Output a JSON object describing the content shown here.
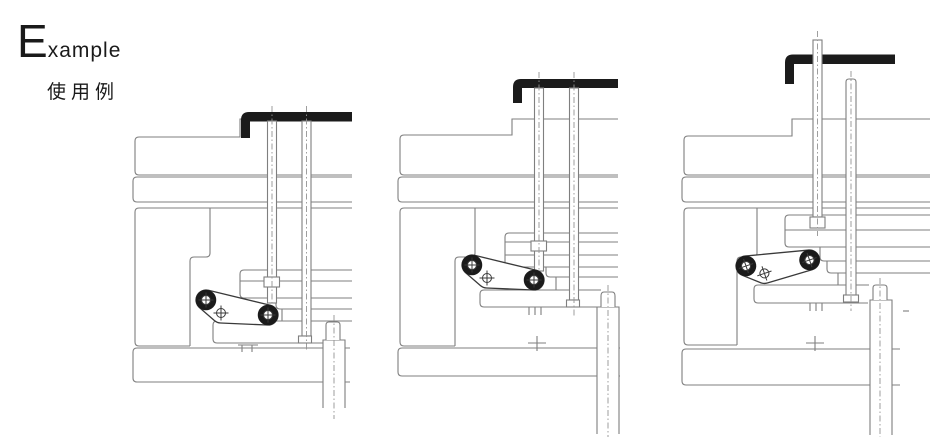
{
  "header": {
    "title_initial": "E",
    "title_rest": "xample",
    "subtitle": "使用例"
  },
  "colors": {
    "background": "#ffffff",
    "line_main": "#7f7f7f",
    "line_dark": "#3a3a3a",
    "line_soft": "#949494",
    "bracket": "#1b1b1b"
  }
}
